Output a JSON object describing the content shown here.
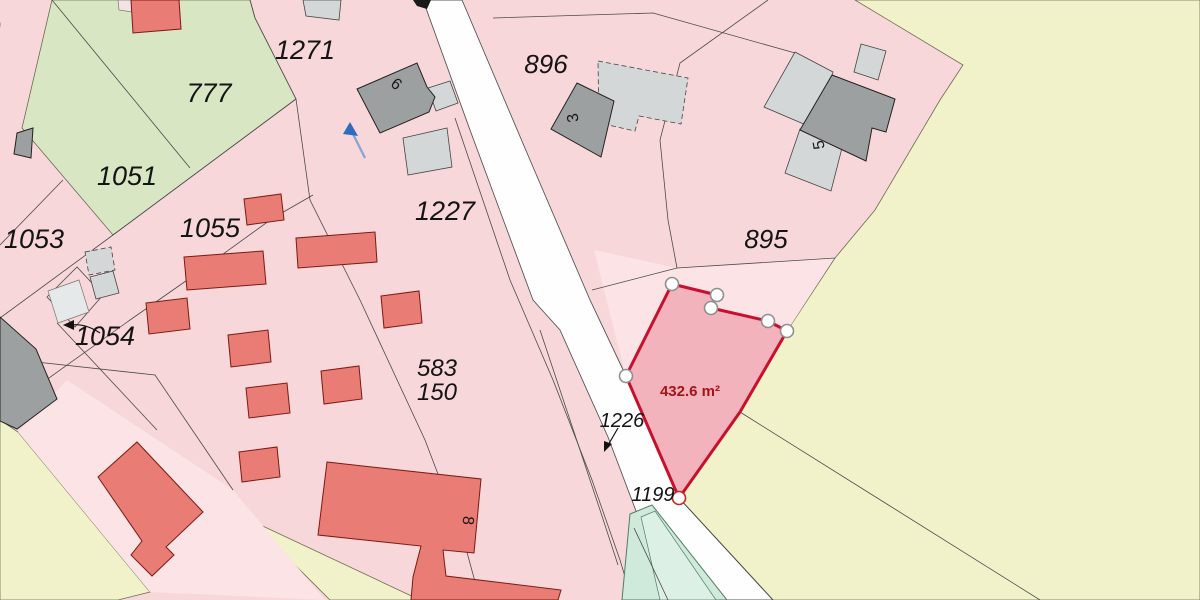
{
  "map": {
    "type": "cadastral-parcel-map",
    "selected_parcel": {
      "area_label": "432.6 m²",
      "outline_color": "#c8102e",
      "fill_color": "#f2b3bc",
      "vertex_count": 7
    },
    "labels": [
      {
        "kind": "parcel",
        "text": "0",
        "x": -7,
        "y": 37,
        "size": 27
      },
      {
        "kind": "parcel",
        "text": "777",
        "x": 209,
        "y": 102,
        "size": 27
      },
      {
        "kind": "parcel",
        "text": "1271",
        "x": 305,
        "y": 59,
        "size": 27
      },
      {
        "kind": "parcel",
        "text": "896",
        "x": 546,
        "y": 73,
        "size": 26
      },
      {
        "kind": "parcel",
        "text": "1051",
        "x": 127,
        "y": 185,
        "size": 27
      },
      {
        "kind": "parcel",
        "text": "1053",
        "x": 34,
        "y": 248,
        "size": 27
      },
      {
        "kind": "parcel",
        "text": "1055",
        "x": 210,
        "y": 237,
        "size": 27
      },
      {
        "kind": "parcel",
        "text": "1054",
        "x": 105,
        "y": 345,
        "size": 27
      },
      {
        "kind": "parcel",
        "text": "1227",
        "x": 445,
        "y": 220,
        "size": 27
      },
      {
        "kind": "parcel",
        "text": "895",
        "x": 766,
        "y": 248,
        "size": 26
      },
      {
        "kind": "parcel",
        "text": "583",
        "x": 437,
        "y": 376,
        "size": 24
      },
      {
        "kind": "parcel",
        "text": "150",
        "x": 437,
        "y": 400,
        "size": 24
      },
      {
        "kind": "parcel",
        "text": "1226",
        "x": 622,
        "y": 427,
        "size": 20
      },
      {
        "kind": "parcel",
        "text": "1199",
        "x": 653,
        "y": 501,
        "size": 20
      },
      {
        "kind": "building",
        "text": "6",
        "x": 393,
        "y": 88,
        "size": 16,
        "rot": 40
      },
      {
        "kind": "building",
        "text": "3",
        "x": 578,
        "y": 117,
        "size": 16,
        "rot": -100
      },
      {
        "kind": "building",
        "text": "5",
        "x": 824,
        "y": 144,
        "size": 16,
        "rot": -100
      },
      {
        "kind": "building",
        "text": "8",
        "x": 463,
        "y": 520,
        "size": 16,
        "rot": 95
      },
      {
        "kind": "measure",
        "text": "432.6 m²",
        "x": 690,
        "y": 396,
        "size": 15
      }
    ],
    "colors": {
      "parcel_pink": "#f8d7da",
      "parcel_pink_light": "#fbe3e6",
      "parcel_green": "#d9e6c3",
      "parcel_yellow": "#f1f2c9",
      "road_white": "#fefefe",
      "vegetation_teal": "#cfe9da",
      "building_red": "#e97c74",
      "building_gray": "#9da0a0",
      "building_light_gray": "#d3d7d7",
      "highlight_stroke": "#c8102e",
      "highlight_fill": "#f2b3bc",
      "measure_text": "#a31515",
      "north_arrow_blue": "#2f6bbf"
    },
    "icons": [
      {
        "name": "blue-arrow-annotation"
      },
      {
        "name": "leader-arrow-1226"
      },
      {
        "name": "leader-arrow-1054"
      },
      {
        "name": "vertex-handle"
      }
    ]
  }
}
